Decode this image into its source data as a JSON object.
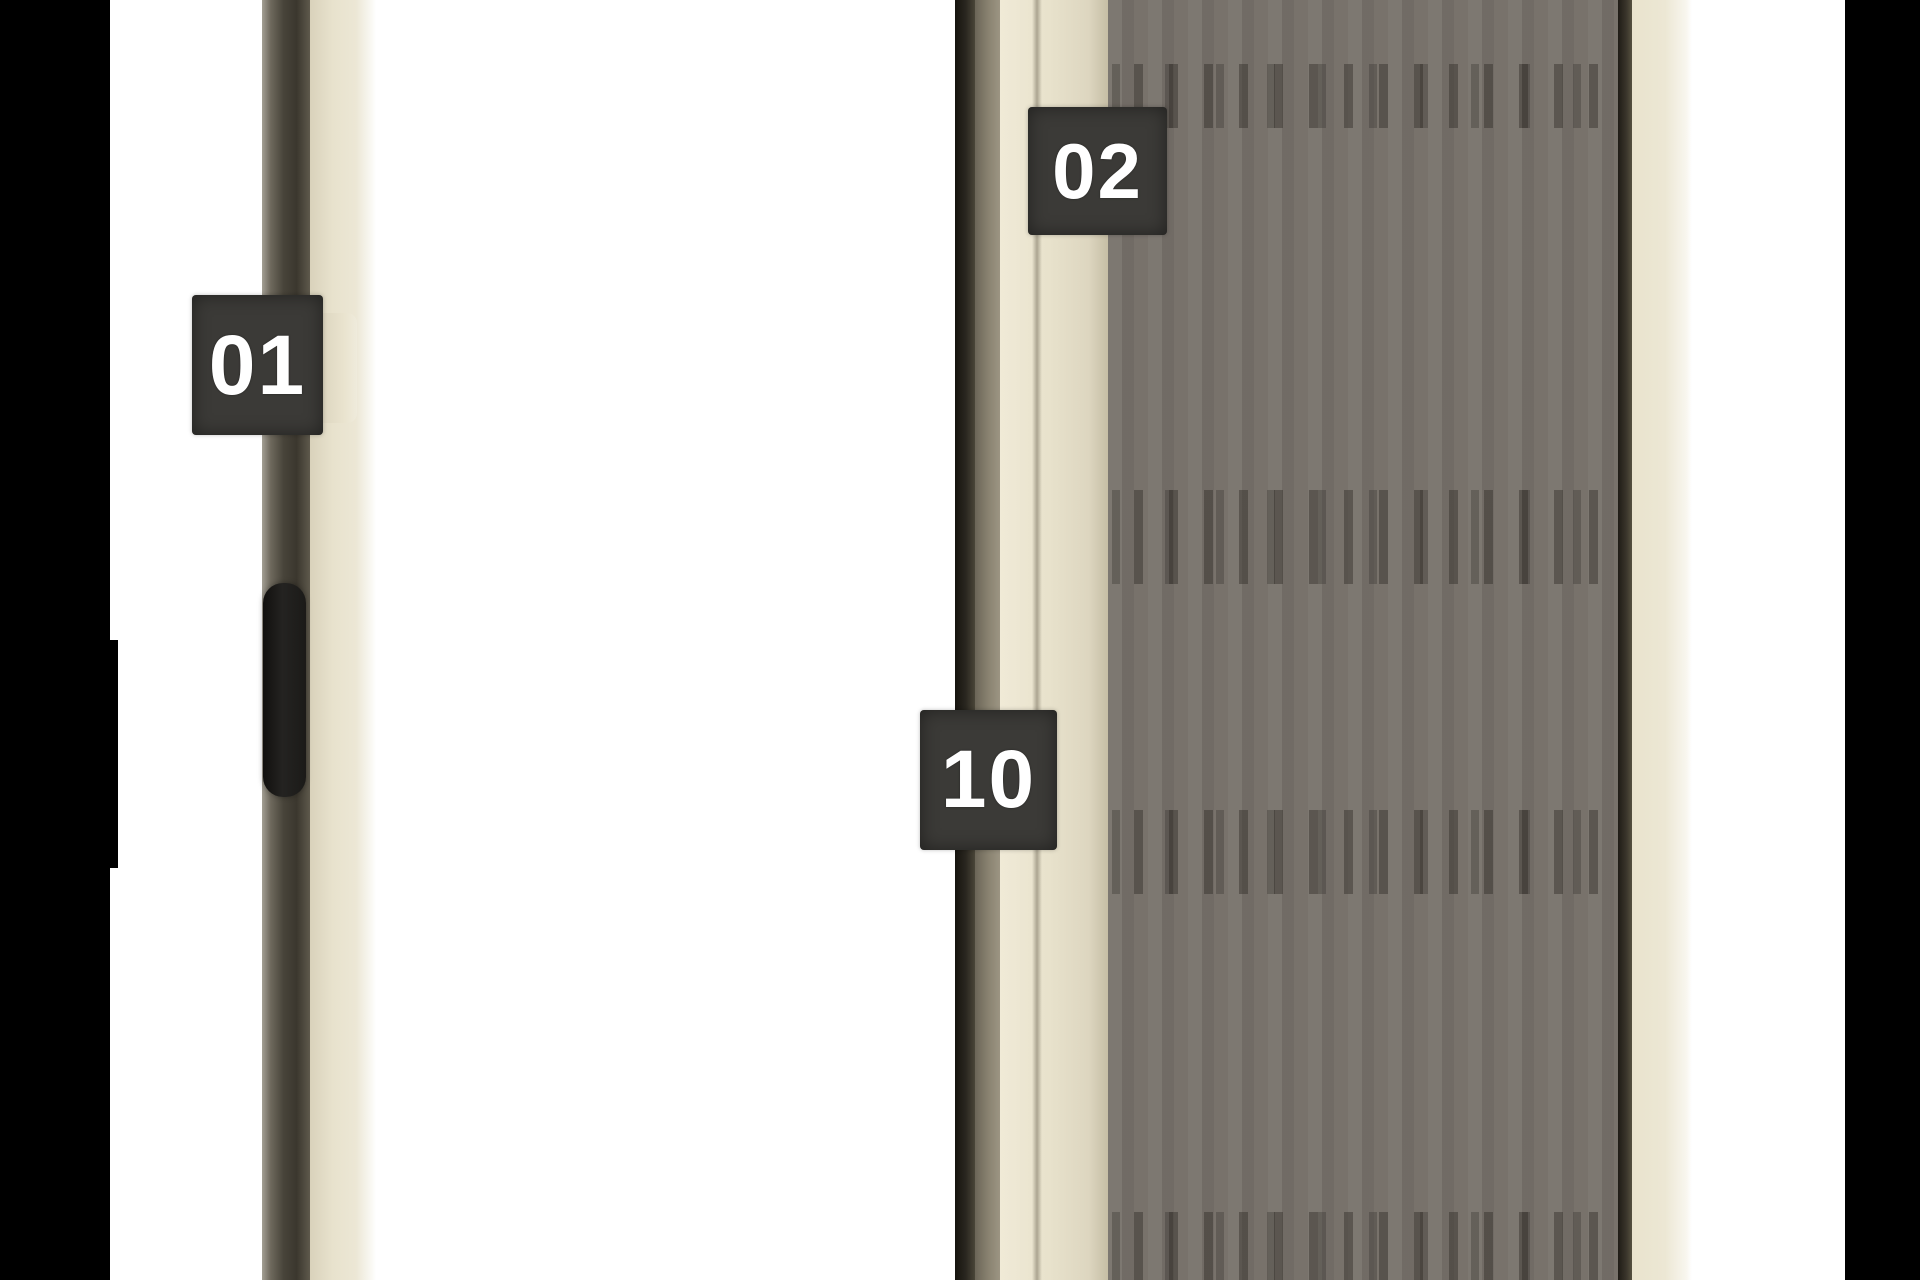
{
  "callouts": [
    {
      "id": "01",
      "label": "01"
    },
    {
      "id": "02",
      "label": "02"
    },
    {
      "id": "10",
      "label": "10"
    }
  ],
  "colors": {
    "background": "#ffffff",
    "panel_black": "#000000",
    "badge_bg": "#3b3a37",
    "badge_text": "#ffffff",
    "rail_dark": "#46412f",
    "cream": "#e8e2cd",
    "mesh": "#78726b"
  }
}
